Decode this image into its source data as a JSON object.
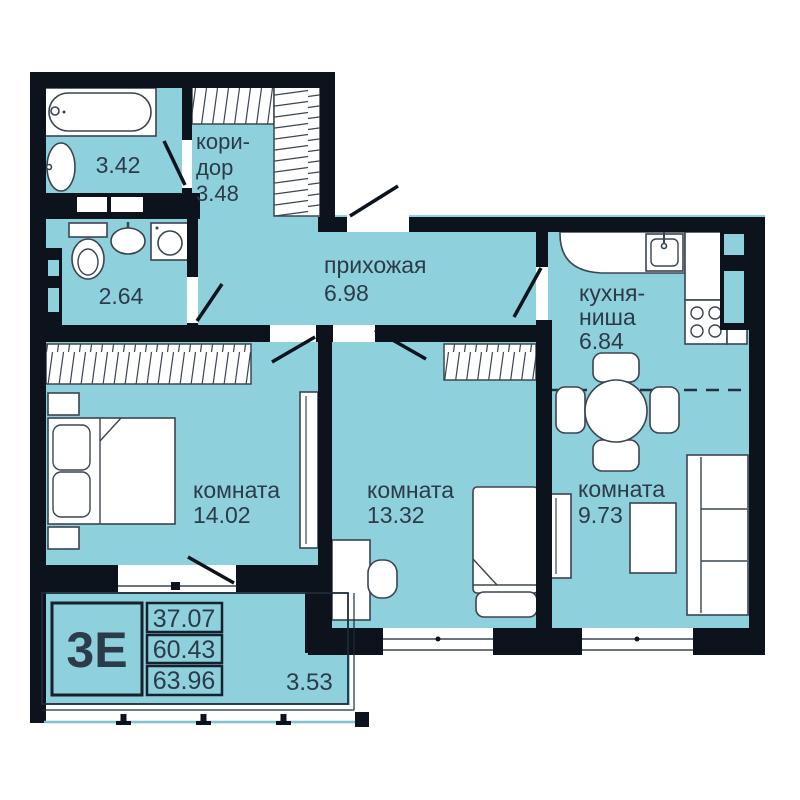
{
  "legend": {
    "type_label": "3Е",
    "area_values": [
      "37.07",
      "60.43",
      "63.96"
    ]
  },
  "balcony": {
    "area": "3.53"
  },
  "rooms": {
    "bathroom": {
      "area": "3.42"
    },
    "corridor": {
      "label1": "кори-",
      "label2": "дор",
      "area": "3.48"
    },
    "wc": {
      "area": "2.64"
    },
    "hallway": {
      "label": "прихожая",
      "area": "6.98"
    },
    "kitchen": {
      "label1": "кухня-",
      "label2": "ниша",
      "area": "6.84"
    },
    "bedroom": {
      "label": "комната",
      "area": "14.02"
    },
    "room2": {
      "label": "комната",
      "area": "13.32"
    },
    "room3": {
      "label": "комната",
      "area": "9.73"
    }
  },
  "colors": {
    "room_fill": "#8ed0db",
    "wall": "#0d131d",
    "text": "#2c3b4a"
  }
}
